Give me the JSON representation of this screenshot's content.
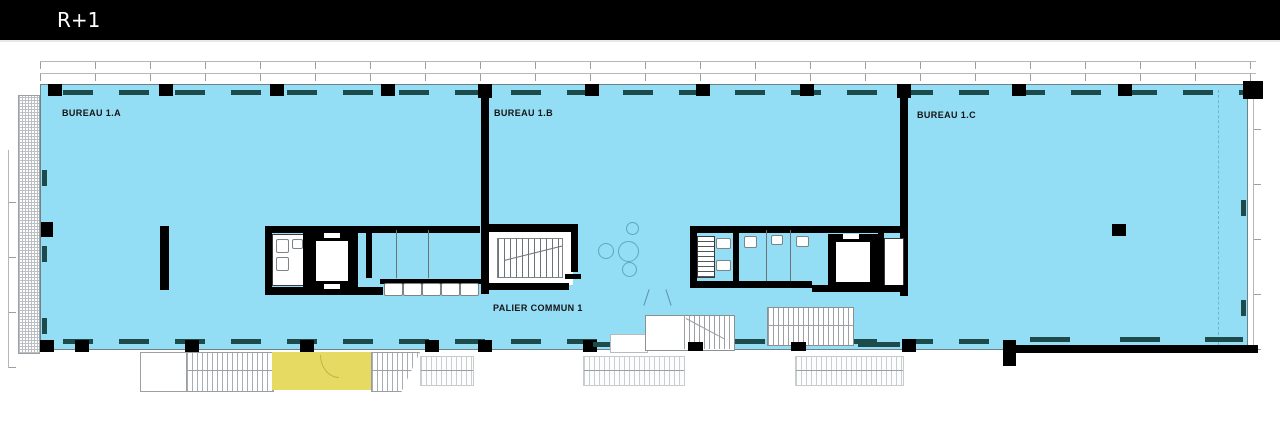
{
  "header": {
    "floor_label": "R+1"
  },
  "plan": {
    "labels": {
      "bureau_a": "BUREAU 1.A",
      "bureau_b": "BUREAU 1.B",
      "bureau_c": "BUREAU 1.C",
      "palier": "PALIER COMMUN 1"
    },
    "colors": {
      "floor": "#93ddf5",
      "highlight": "#e7da62",
      "wall": "#000000",
      "mullion": "#1d4a4a",
      "header-bg": "#000000",
      "header-fg": "#ffffff"
    }
  }
}
